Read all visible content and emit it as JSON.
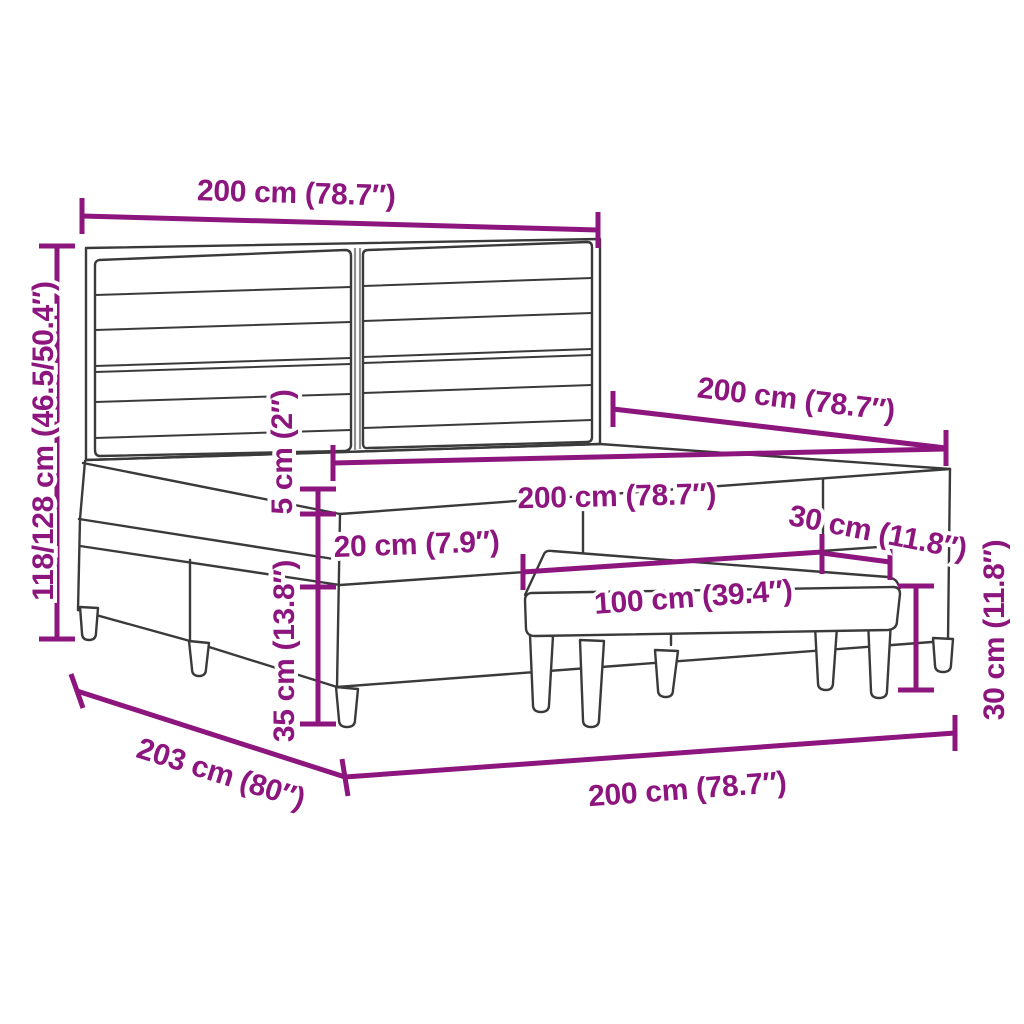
{
  "diagram": {
    "subject": "box-spring-bed-with-headboard-and-bench-dimensions",
    "colors": {
      "dimension": "#8D157E",
      "outline": "#3A3A3A",
      "background": "#FFFFFF"
    },
    "dims": {
      "headboard_width": "200 cm (78.7″)",
      "total_height": "118/128 cm (46.5/50.4″)",
      "depth_top": "200 cm (78.7″)",
      "mattress_width": "200 cm (78.7″)",
      "pillow_top_height": "5 cm (2″)",
      "mattress_height": "20 cm (7.9″)",
      "base_height": "35 cm (13.8″)",
      "bench_length": "100 cm (39.4″)",
      "bench_depth": "30 cm (11.8″)",
      "bench_height": "30 cm (11.8″)",
      "depth_bottom": "203 cm (80″)",
      "width_bottom": "200 cm (78.7″)"
    }
  }
}
